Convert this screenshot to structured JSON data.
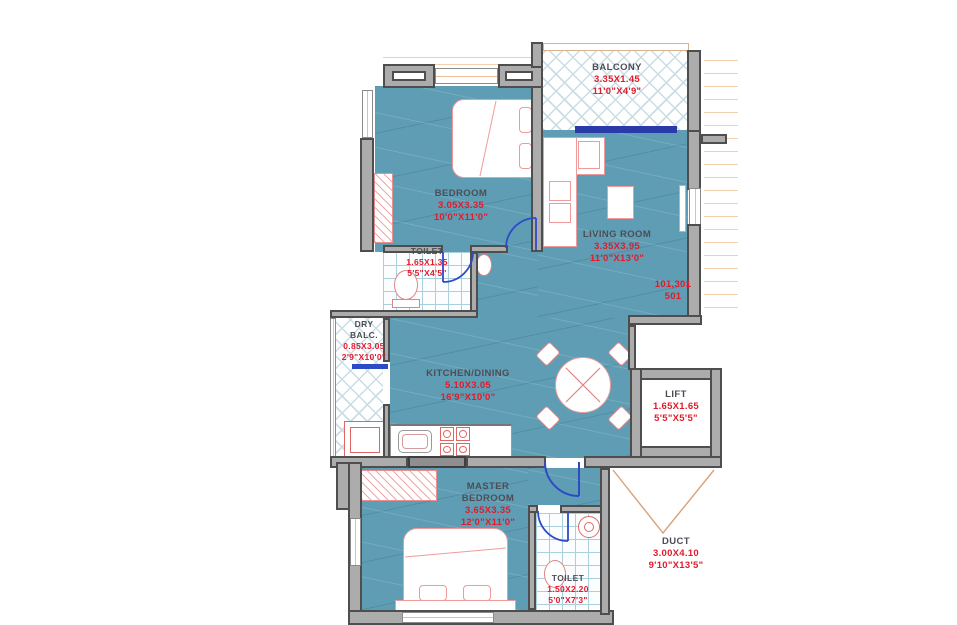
{
  "plan": {
    "title": "2BHK apartment floor plan",
    "colors": {
      "floor_teal": "#5E9DB4",
      "wall_fill": "#ACACAC",
      "wall_border": "#4E4E4E",
      "dimension_text": "#E11B2B",
      "room_name_text": "#4D4D55",
      "door_blue": "#2E4BC6",
      "slider_blue": "#2A3AA8",
      "lattice_blue": "#C9DDE5",
      "tile_blue": "#AACFDD",
      "window_line_peach": "#EEBB92",
      "furniture_outline": "#EF9B9B"
    },
    "rooms": [
      {
        "id": "balcony",
        "name": "BALCONY",
        "dim_m": "3.35X1.45",
        "dim_ft": "11'0\"X4'9\""
      },
      {
        "id": "bedroom",
        "name": "BEDROOM",
        "dim_m": "3.05X3.35",
        "dim_ft": "10'0\"X11'0\""
      },
      {
        "id": "toilet_1",
        "name": "TOILET",
        "dim_m": "1.65X1.35",
        "dim_ft": "5'5\"X4'5\""
      },
      {
        "id": "living_room",
        "name": "LIVING ROOM",
        "dim_m": "3.35X3.95",
        "dim_ft": "11'0\"X13'0\""
      },
      {
        "id": "dry_balcony",
        "name": "DRY BALC.",
        "name_lines": [
          "DRY",
          "BALC."
        ],
        "dim_m": "0.85X3.05",
        "dim_ft": "2'9\"X10'0\""
      },
      {
        "id": "kitchen_dining",
        "name": "KITCHEN/DINING",
        "dim_m": "5.10X3.05",
        "dim_ft": "16'9\"X10'0\""
      },
      {
        "id": "lift",
        "name": "LIFT",
        "dim_m": "1.65X1.65",
        "dim_ft": "5'5\"X5'5\""
      },
      {
        "id": "master_bedroom",
        "name": "MASTER BEDROOM",
        "name_lines": [
          "MASTER",
          "BEDROOM"
        ],
        "dim_m": "3.65X3.35",
        "dim_ft": "12'0\"X11'0\""
      },
      {
        "id": "toilet_2",
        "name": "TOILET",
        "dim_m": "1.50X2.20",
        "dim_ft": "5'0\"X7'3\""
      },
      {
        "id": "duct",
        "name": "DUCT",
        "dim_m": "3.00X4.10",
        "dim_ft": "9'10\"X13'5\""
      }
    ],
    "unit_numbers": {
      "line1": "101,301",
      "line2": "501"
    }
  }
}
